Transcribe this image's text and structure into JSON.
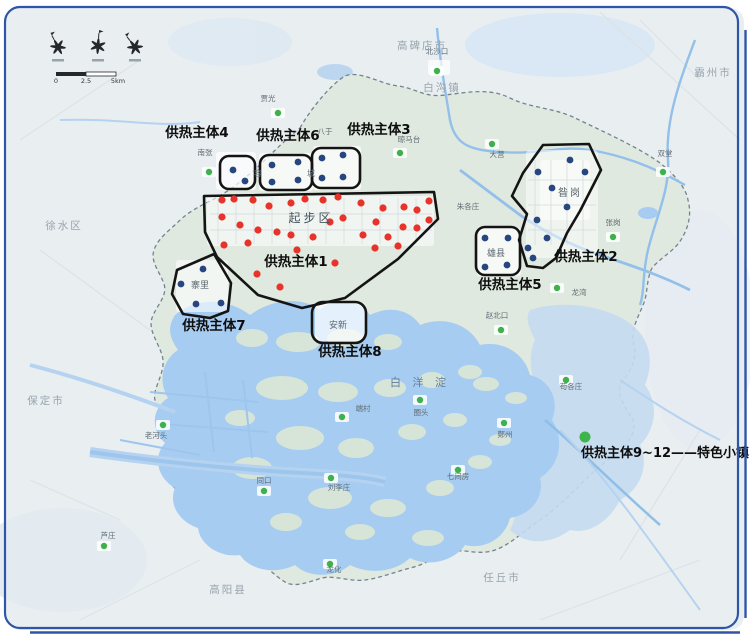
{
  "map": {
    "colors": {
      "red_dot": "#e8332a",
      "blue_dot": "#27457e",
      "village_dot": "#3fb14c",
      "legend_dot": "#3cb54a",
      "zone_outline": "#141414",
      "frame": "#2f55a8",
      "region_fill": "#dfe9df",
      "lake_fill": "#a6ccf1"
    },
    "zone_labels": [
      {
        "t": "供热主体4",
        "x": 197,
        "y": 137
      },
      {
        "t": "供热主体6",
        "x": 288,
        "y": 140
      },
      {
        "t": "供热主体3",
        "x": 379,
        "y": 134
      },
      {
        "t": "供热主体1",
        "x": 296,
        "y": 266
      },
      {
        "t": "供热主体2",
        "x": 586,
        "y": 261
      },
      {
        "t": "供热主体5",
        "x": 510,
        "y": 289
      },
      {
        "t": "供热主体7",
        "x": 214,
        "y": 330
      },
      {
        "t": "供热主体8",
        "x": 350,
        "y": 356
      }
    ],
    "legend": {
      "text": "供热主体9~12——特色小镇",
      "dot_x": 585,
      "dot_y": 437
    },
    "scalebar": {
      "labels": [
        "0",
        "2.5",
        "5km"
      ]
    },
    "region_labels": [
      {
        "t": "高碑店市",
        "x": 422,
        "y": 49
      },
      {
        "t": "白沟镇",
        "x": 442,
        "y": 91
      },
      {
        "t": "霸州市",
        "x": 713,
        "y": 76
      },
      {
        "t": "徐水区",
        "x": 64,
        "y": 229
      },
      {
        "t": "保定市",
        "x": 46,
        "y": 404
      },
      {
        "t": "高阳县",
        "x": 228,
        "y": 593
      },
      {
        "t": "任丘市",
        "x": 502,
        "y": 581
      }
    ],
    "place_labels": [
      {
        "t": "起步区",
        "x": 311,
        "y": 222,
        "s": 12,
        "c": "#46535c",
        "ls": 3
      },
      {
        "t": "容",
        "x": 258,
        "y": 176,
        "s": 8,
        "c": "#6a757d"
      },
      {
        "t": "城",
        "x": 311,
        "y": 176,
        "s": 8,
        "c": "#6a757d"
      },
      {
        "t": "雄县",
        "x": 496,
        "y": 256,
        "s": 9,
        "c": "#5c676f"
      },
      {
        "t": "昝岗",
        "x": 570,
        "y": 196,
        "s": 10,
        "c": "#59646d",
        "ls": 2
      },
      {
        "t": "安新",
        "x": 338,
        "y": 328,
        "s": 9,
        "c": "#5c676f"
      },
      {
        "t": "寨里",
        "x": 200,
        "y": 288,
        "s": 9,
        "c": "#5c676f"
      },
      {
        "t": "白 洋 淀",
        "x": 420,
        "y": 386,
        "s": 11,
        "c": "#5e7b9b",
        "ls": 4
      }
    ],
    "villages": [
      {
        "t": "贾光",
        "x": 268,
        "y": 101,
        "d": [
          278,
          113
        ]
      },
      {
        "t": "北沙口",
        "x": 437,
        "y": 54,
        "d": [
          437,
          71
        ]
      },
      {
        "t": "八于",
        "x": 325,
        "y": 134
      },
      {
        "t": "晾马台",
        "x": 409,
        "y": 142,
        "d": [
          400,
          153
        ]
      },
      {
        "t": "南张",
        "x": 205,
        "y": 155,
        "d": [
          209,
          172
        ]
      },
      {
        "t": "大营",
        "x": 497,
        "y": 157,
        "d": [
          492,
          144
        ]
      },
      {
        "t": "双堂",
        "x": 665,
        "y": 156,
        "d": [
          663,
          172
        ]
      },
      {
        "t": "张岗",
        "x": 613,
        "y": 225,
        "d": [
          613,
          237
        ]
      },
      {
        "t": "朱各庄",
        "x": 468,
        "y": 209
      },
      {
        "t": "龙湾",
        "x": 579,
        "y": 295,
        "d": [
          557,
          288
        ]
      },
      {
        "t": "赵北口",
        "x": 497,
        "y": 318,
        "d": [
          501,
          330
        ]
      },
      {
        "t": "苟各庄",
        "x": 571,
        "y": 389,
        "d": [
          566,
          380
        ]
      },
      {
        "t": "鄚州",
        "x": 505,
        "y": 437,
        "d": [
          504,
          423
        ]
      },
      {
        "t": "圈头",
        "x": 421,
        "y": 415,
        "d": [
          420,
          400
        ]
      },
      {
        "t": "端村",
        "x": 363,
        "y": 411,
        "d": [
          342,
          417
        ]
      },
      {
        "t": "七间房",
        "x": 458,
        "y": 479,
        "d": [
          458,
          470
        ]
      },
      {
        "t": "老河头",
        "x": 156,
        "y": 438,
        "d": [
          163,
          425
        ]
      },
      {
        "t": "同口",
        "x": 264,
        "y": 483,
        "d": [
          264,
          491
        ]
      },
      {
        "t": "刘李庄",
        "x": 339,
        "y": 490,
        "d": [
          331,
          478
        ]
      },
      {
        "t": "芦庄",
        "x": 108,
        "y": 538,
        "d": [
          104,
          546
        ]
      },
      {
        "t": "龙化",
        "x": 334,
        "y": 572,
        "d": [
          330,
          564
        ]
      }
    ],
    "dot_groups": [
      {
        "name": "red-heat-source-dots",
        "dot_name": "red-heat-source-dot",
        "color": "#e8332a",
        "r": 3.6,
        "points": [
          [
            222,
            200
          ],
          [
            234,
            199
          ],
          [
            253,
            200
          ],
          [
            269,
            206
          ],
          [
            291,
            203
          ],
          [
            305,
            199
          ],
          [
            323,
            200
          ],
          [
            338,
            197
          ],
          [
            361,
            203
          ],
          [
            383,
            208
          ],
          [
            404,
            207
          ],
          [
            417,
            210
          ],
          [
            429,
            201
          ],
          [
            222,
            217
          ],
          [
            240,
            225
          ],
          [
            258,
            230
          ],
          [
            277,
            232
          ],
          [
            291,
            235
          ],
          [
            313,
            237
          ],
          [
            330,
            222
          ],
          [
            343,
            218
          ],
          [
            363,
            235
          ],
          [
            376,
            222
          ],
          [
            388,
            237
          ],
          [
            403,
            227
          ],
          [
            417,
            228
          ],
          [
            429,
            220
          ],
          [
            224,
            245
          ],
          [
            248,
            243
          ],
          [
            297,
            250
          ],
          [
            335,
            263
          ],
          [
            375,
            248
          ],
          [
            398,
            246
          ],
          [
            257,
            274
          ],
          [
            280,
            287
          ]
        ]
      },
      {
        "name": "blue-heat-source-dots",
        "dot_name": "blue-heat-source-dot",
        "color": "#27457e",
        "r": 3.4,
        "points": [
          [
            233,
            170
          ],
          [
            245,
            181
          ],
          [
            272,
            165
          ],
          [
            298,
            162
          ],
          [
            272,
            182
          ],
          [
            298,
            180
          ],
          [
            322,
            158
          ],
          [
            343,
            155
          ],
          [
            322,
            178
          ],
          [
            343,
            177
          ],
          [
            485,
            238
          ],
          [
            508,
            238
          ],
          [
            485,
            267
          ],
          [
            507,
            265
          ],
          [
            203,
            269
          ],
          [
            181,
            284
          ],
          [
            196,
            304
          ],
          [
            221,
            303
          ],
          [
            570,
            160
          ],
          [
            538,
            172
          ],
          [
            585,
            172
          ],
          [
            552,
            188
          ],
          [
            567,
            207
          ],
          [
            537,
            220
          ],
          [
            547,
            238
          ],
          [
            528,
            248
          ],
          [
            533,
            258
          ]
        ]
      }
    ]
  }
}
